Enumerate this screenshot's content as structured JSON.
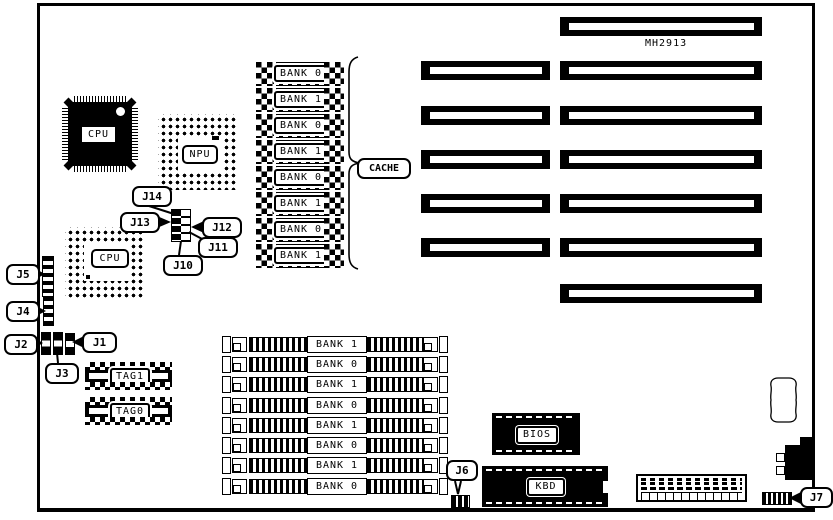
{
  "board": {
    "part_number": "MH2913",
    "chips": {
      "cpu_qfp_label": "CPU",
      "npu_label": "NPU",
      "cpu_pga_label": "CPU",
      "bios_label": "BIOS",
      "kbd_label": "KBD",
      "tag1_label": "TAG1",
      "tag0_label": "TAG0"
    },
    "cache": {
      "group_label": "CACHE",
      "banks": [
        "BANK 0",
        "BANK 1",
        "BANK 0",
        "BANK 1",
        "BANK 0",
        "BANK 1",
        "BANK 0",
        "BANK 1"
      ]
    },
    "simm": {
      "banks": [
        "BANK 1",
        "BANK 0",
        "BANK 1",
        "BANK 0",
        "BANK 1",
        "BANK 0",
        "BANK 1",
        "BANK 0"
      ]
    },
    "jumpers": {
      "j1": "J1",
      "j2": "J2",
      "j3": "J3",
      "j4": "J4",
      "j5": "J5",
      "j6": "J6",
      "j7": "J7",
      "j10": "J10",
      "j11": "J11",
      "j12": "J12",
      "j13": "J13",
      "j14": "J14"
    }
  }
}
